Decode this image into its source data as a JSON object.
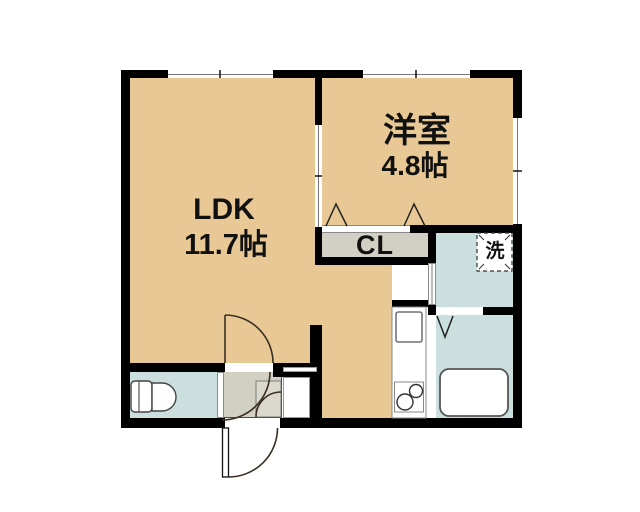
{
  "floorplan": {
    "title": "1LDK apartment floor plan",
    "rooms": {
      "ldk": {
        "name": "LDK",
        "size": "11.7帖"
      },
      "western": {
        "name": "洋室",
        "size": "4.8帖"
      },
      "closet": {
        "name": "CL"
      },
      "laundry": {
        "name": "洗"
      }
    },
    "icons": {
      "toilet": "toilet-icon",
      "bathtub": "bathtub-icon",
      "kitchen_sink": "sink-icon",
      "gas_stove": "stove-icon",
      "washer_pan": "washer-pan-icon",
      "entry_door": "entry-door-swing-icon",
      "window": "sliding-window-icon",
      "folding_door": "folding-door-triangle-icon"
    },
    "colors": {
      "room_floor": "#E8C995",
      "wet_floor": "#CBDFDE",
      "closet_floor": "#D2CFC4",
      "entry_floor": "#D2CFC3",
      "wall": "#000000",
      "arc_line": "#3A2F23",
      "label_text": "#111111"
    }
  }
}
